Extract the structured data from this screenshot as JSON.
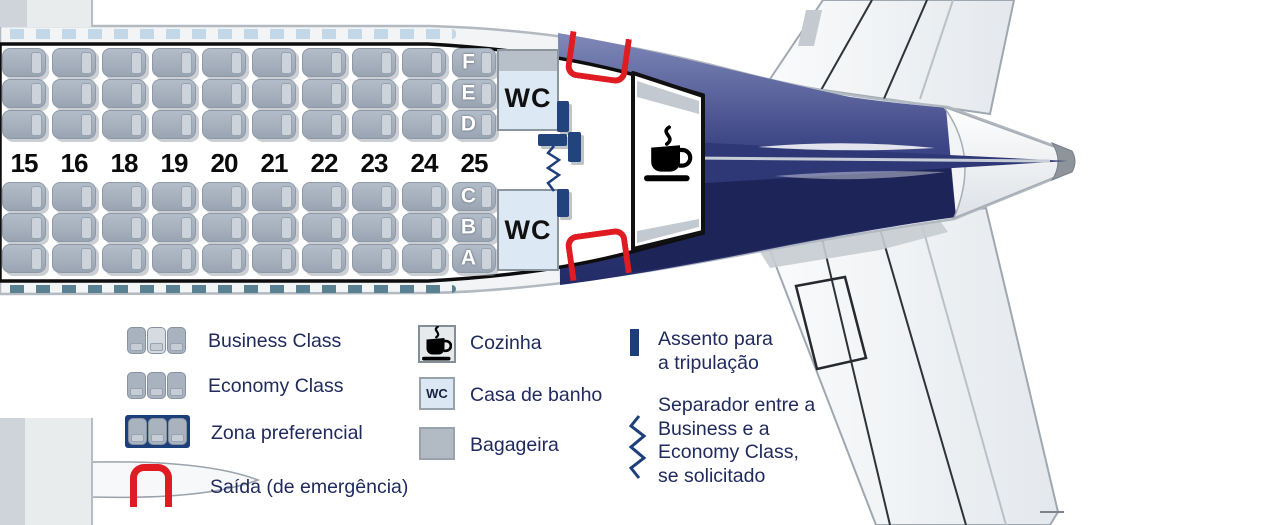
{
  "plane": {
    "rows": [
      "15",
      "16",
      "18",
      "19",
      "20",
      "21",
      "22",
      "23",
      "24",
      "25"
    ],
    "letters_top": [
      "F",
      "E",
      "D"
    ],
    "letters_bottom": [
      "C",
      "B",
      "A"
    ],
    "lavatory_label": "WC"
  },
  "legend": {
    "business": "Business Class",
    "economy": "Economy Class",
    "preferential": "Zona preferencial",
    "exit": "Saída (de emergência)",
    "galley": "Cozinha",
    "lavatory": "Casa de banho",
    "storage": "Bagageira",
    "crew_seat": "Assento para a tripulação",
    "separator": "Separador entre a Business e a Economy Class, se solicitado",
    "wc_icon": "WC"
  },
  "colors": {
    "red": "#e01b22",
    "navy_tail_dark": "#1d2457",
    "navy_tail": "#2e3876",
    "crew_navy": "#21447c",
    "preferential_navy": "#1c3e79",
    "seat_gray": "#a9b3c0",
    "lavatory_blue": "#dce8f4",
    "text_navy": "#202a5c"
  }
}
